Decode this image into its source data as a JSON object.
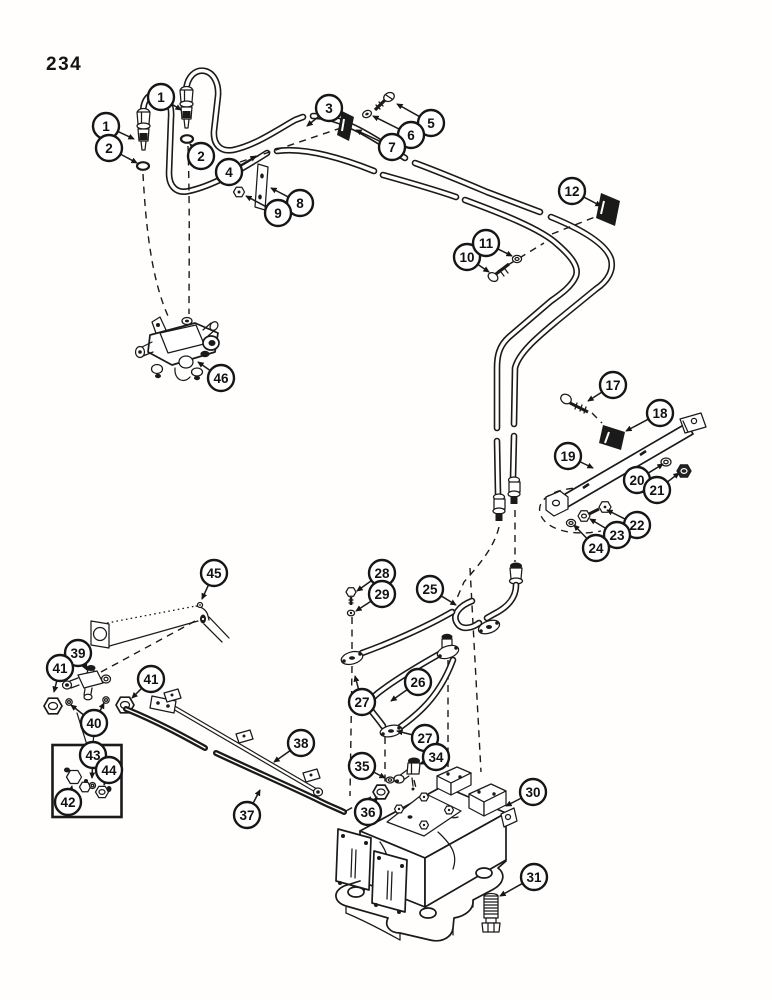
{
  "page": {
    "number": "234"
  },
  "figure": {
    "type": "exploded-parts-diagram",
    "ink": "#1a1a1a",
    "paper": "#ffffff",
    "callout_radius": 13,
    "callouts": [
      {
        "label": "1",
        "cx": 161,
        "cy": 97,
        "tips": [
          [
            181,
            110
          ]
        ]
      },
      {
        "label": "1",
        "cx": 106,
        "cy": 126,
        "tips": [
          [
            134,
            139
          ]
        ]
      },
      {
        "label": "2",
        "cx": 109,
        "cy": 148,
        "tips": [
          [
            137,
            163
          ]
        ]
      },
      {
        "label": "2",
        "cx": 201,
        "cy": 156,
        "tips": [
          [
            190,
            144
          ]
        ]
      },
      {
        "label": "3",
        "cx": 329,
        "cy": 108,
        "tips": [
          [
            307,
            126
          ]
        ]
      },
      {
        "label": "4",
        "cx": 229,
        "cy": 172,
        "tips": [
          [
            256,
            156
          ]
        ]
      },
      {
        "label": "5",
        "cx": 431,
        "cy": 123,
        "tips": [
          [
            397,
            104
          ]
        ]
      },
      {
        "label": "6",
        "cx": 411,
        "cy": 135,
        "tips": [
          [
            373,
            116
          ]
        ]
      },
      {
        "label": "7",
        "cx": 392,
        "cy": 147,
        "tips": [
          [
            356,
            130
          ]
        ]
      },
      {
        "label": "8",
        "cx": 300,
        "cy": 203,
        "tips": [
          [
            271,
            188
          ]
        ]
      },
      {
        "label": "9",
        "cx": 278,
        "cy": 213,
        "tips": [
          [
            246,
            196
          ]
        ]
      },
      {
        "label": "10",
        "cx": 467,
        "cy": 257,
        "tips": [
          [
            489,
            272
          ]
        ]
      },
      {
        "label": "11",
        "cx": 486,
        "cy": 243,
        "tips": [
          [
            512,
            256
          ]
        ]
      },
      {
        "label": "12",
        "cx": 572,
        "cy": 191,
        "tips": [
          [
            601,
            206
          ]
        ]
      },
      {
        "label": "17",
        "cx": 613,
        "cy": 385,
        "tips": [
          [
            588,
            401
          ]
        ]
      },
      {
        "label": "18",
        "cx": 660,
        "cy": 413,
        "tips": [
          [
            626,
            431
          ]
        ]
      },
      {
        "label": "19",
        "cx": 568,
        "cy": 456,
        "tips": [
          [
            593,
            468
          ]
        ]
      },
      {
        "label": "20",
        "cx": 637,
        "cy": 480,
        "tips": [
          [
            663,
            464
          ]
        ]
      },
      {
        "label": "21",
        "cx": 657,
        "cy": 490,
        "tips": [
          [
            679,
            473
          ]
        ]
      },
      {
        "label": "22",
        "cx": 637,
        "cy": 525,
        "tips": [
          [
            607,
            510
          ]
        ]
      },
      {
        "label": "23",
        "cx": 617,
        "cy": 535,
        "tips": [
          [
            590,
            519
          ]
        ]
      },
      {
        "label": "24",
        "cx": 596,
        "cy": 548,
        "tips": [
          [
            574,
            525
          ]
        ]
      },
      {
        "label": "25",
        "cx": 430,
        "cy": 589,
        "tips": [
          [
            456,
            605
          ]
        ]
      },
      {
        "label": "26",
        "cx": 418,
        "cy": 682,
        "tips": [
          [
            391,
            701
          ]
        ]
      },
      {
        "label": "27",
        "cx": 362,
        "cy": 702,
        "tips": [
          [
            355,
            676
          ]
        ]
      },
      {
        "label": "27",
        "cx": 425,
        "cy": 738,
        "tips": [
          [
            397,
            731
          ]
        ]
      },
      {
        "label": "28",
        "cx": 382,
        "cy": 573,
        "tips": [
          [
            357,
            591
          ]
        ]
      },
      {
        "label": "29",
        "cx": 382,
        "cy": 594,
        "tips": [
          [
            356,
            611
          ]
        ]
      },
      {
        "label": "30",
        "cx": 533,
        "cy": 792,
        "tips": [
          [
            506,
            806
          ]
        ]
      },
      {
        "label": "31",
        "cx": 534,
        "cy": 877,
        "tips": [
          [
            500,
            896
          ]
        ]
      },
      {
        "label": "34",
        "cx": 436,
        "cy": 757,
        "tips": [
          [
            420,
            764
          ]
        ]
      },
      {
        "label": "35",
        "cx": 362,
        "cy": 766,
        "tips": [
          [
            385,
            778
          ]
        ]
      },
      {
        "label": "36",
        "cx": 368,
        "cy": 812,
        "tips": [
          [
            377,
            797
          ]
        ]
      },
      {
        "label": "37",
        "cx": 247,
        "cy": 815,
        "tips": [
          [
            260,
            790
          ]
        ]
      },
      {
        "label": "38",
        "cx": 301,
        "cy": 743,
        "tips": [
          [
            274,
            762
          ]
        ]
      },
      {
        "label": "39",
        "cx": 78,
        "cy": 653,
        "tips": [
          [
            87,
            670
          ]
        ]
      },
      {
        "label": "40",
        "cx": 94,
        "cy": 723,
        "tips": [
          [
            71,
            705
          ],
          [
            104,
            703
          ]
        ]
      },
      {
        "label": "41",
        "cx": 60,
        "cy": 668,
        "tips": [
          [
            54,
            692
          ]
        ]
      },
      {
        "label": "41",
        "cx": 151,
        "cy": 679,
        "tips": [
          [
            132,
            698
          ]
        ]
      },
      {
        "label": "42",
        "cx": 68,
        "cy": 802,
        "tips": [
          [
            72,
            786
          ]
        ]
      },
      {
        "label": "43",
        "cx": 93,
        "cy": 755,
        "tips": [
          [
            92,
            778
          ]
        ]
      },
      {
        "label": "44",
        "cx": 109,
        "cy": 770,
        "tips": [
          [
            104,
            785
          ]
        ]
      },
      {
        "label": "45",
        "cx": 214,
        "cy": 573,
        "tips": [
          [
            202,
            599
          ]
        ]
      },
      {
        "label": "46",
        "cx": 221,
        "cy": 378,
        "tips": [
          [
            198,
            362
          ]
        ]
      }
    ]
  }
}
